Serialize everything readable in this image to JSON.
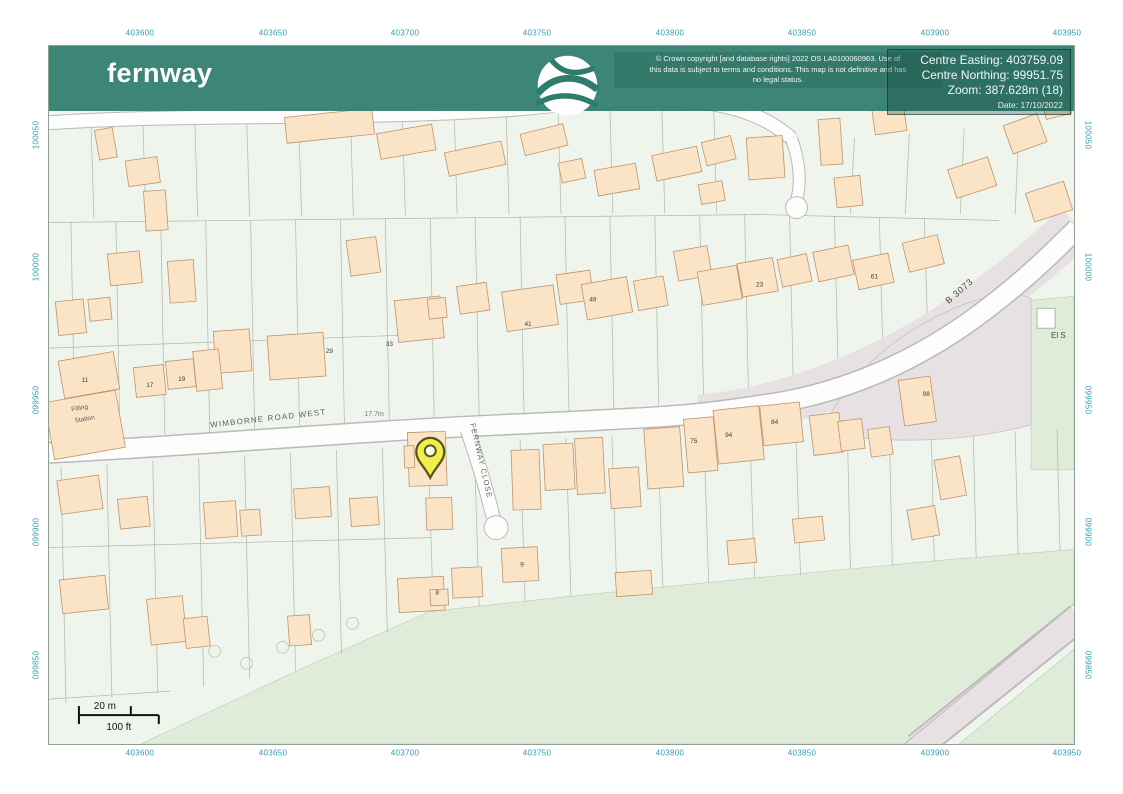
{
  "header": {
    "brand": "fernway",
    "copyright_lines": [
      "© Crown copyright [and database rights] 2022 OS LA0100060963. Use of",
      "this data is subject to terms and conditions. This map is not definitive and has",
      "no legal status."
    ],
    "info_lines": [
      "Centre Easting: 403759.09",
      "Centre Northing: 99951.75",
      "Zoom: 387.628m (18)"
    ],
    "date_line": "Date: 17/10/2022"
  },
  "grid": {
    "x_labels": [
      "403600",
      "403650",
      "403700",
      "403750",
      "403800",
      "403850",
      "403900",
      "403950"
    ],
    "y_labels": [
      "100050",
      "100000",
      "099950",
      "099900",
      "099850"
    ]
  },
  "map": {
    "roads": {
      "main": "WIMBORNE ROAD WEST",
      "close": "FERNWAY CLOSE",
      "b_road": "B 3073"
    },
    "spot_height": "17.7m",
    "station_lines": [
      "Filling",
      "Station"
    ],
    "substation": "El S",
    "house_numbers": [
      {
        "t": "11",
        "x": 84,
        "y": 382
      },
      {
        "t": "17",
        "x": 149,
        "y": 387
      },
      {
        "t": "19",
        "x": 181,
        "y": 381
      },
      {
        "t": "29",
        "x": 329,
        "y": 353
      },
      {
        "t": "33",
        "x": 389,
        "y": 346
      },
      {
        "t": "41",
        "x": 528,
        "y": 326
      },
      {
        "t": "49",
        "x": 593,
        "y": 301
      },
      {
        "t": "23",
        "x": 760,
        "y": 286
      },
      {
        "t": "61",
        "x": 875,
        "y": 278
      },
      {
        "t": "75",
        "x": 694,
        "y": 443
      },
      {
        "t": "94",
        "x": 729,
        "y": 437
      },
      {
        "t": "84",
        "x": 775,
        "y": 424
      },
      {
        "t": "98",
        "x": 927,
        "y": 396
      },
      {
        "t": "9",
        "x": 522,
        "y": 567
      },
      {
        "t": "8",
        "x": 437,
        "y": 595
      }
    ]
  },
  "scalebar": {
    "metric": "20 m",
    "imperial": "100 ft"
  },
  "colors": {
    "banner": "#2e7c6c",
    "grid_label": "#2f9fae",
    "building_fill": "#fbe4c6",
    "building_stroke": "#c0936a",
    "field": "#dfecd9",
    "road_corridor": "#e8e1e4",
    "pin_fill": "#f2ee4e",
    "pin_stroke": "#55551a",
    "map_bg": "#eff5ed"
  }
}
